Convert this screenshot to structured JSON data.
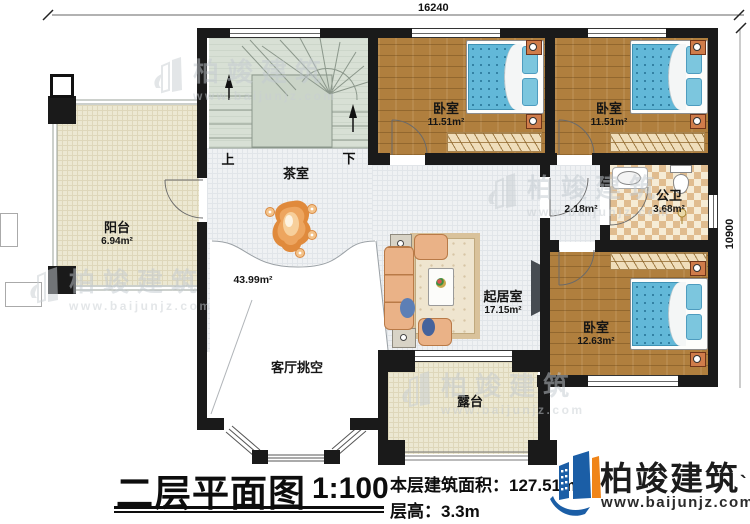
{
  "dimensions": {
    "width_mm": "16240",
    "depth_mm": "10900"
  },
  "stairs": {
    "up": "上",
    "down": "下"
  },
  "rooms": {
    "balcony": {
      "label": "阳台",
      "area": "6.94m²"
    },
    "tearoom": {
      "label": "茶室"
    },
    "bedroom1": {
      "label": "卧室",
      "area": "11.51m²"
    },
    "bedroom2": {
      "label": "卧室",
      "area": "11.51m²"
    },
    "corridor": {
      "area": "2.18m²"
    },
    "bathroom": {
      "label": "公卫",
      "area": "3.68m²"
    },
    "living": {
      "label": "起居室",
      "area": "17.15m²"
    },
    "bedroom3": {
      "label": "卧室",
      "area": "12.63m²"
    },
    "void": {
      "label": "客厅挑空",
      "area": "43.99m²"
    },
    "terrace": {
      "label": "露台"
    }
  },
  "titleblock": {
    "title": "二层平面图",
    "scale": "1:100",
    "area_line": "本层建筑面积：127.51m²",
    "height_line": "层高：3.3m"
  },
  "brand": {
    "name": "柏竣建筑",
    "tick": "`",
    "url": "www.baijunjz.com"
  },
  "watermark": {
    "name": "柏竣建筑",
    "url": "www.baijunjz.com"
  },
  "colors": {
    "brand_blue": "#1b5ea6",
    "brand_orange": "#f08519",
    "bed_blue": "#62b8d8",
    "wood": "#b07f3e",
    "wall": "#1a1a1a"
  }
}
